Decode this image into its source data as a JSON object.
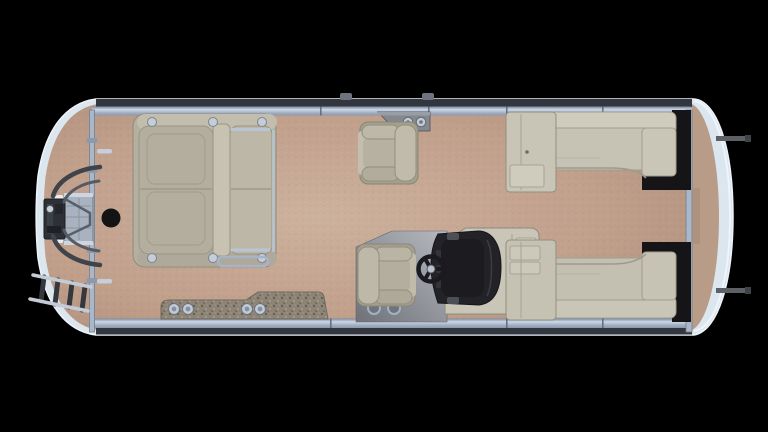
{
  "scene": {
    "type": "pontoon-boat-floorplan-top-view",
    "background": "#000000"
  },
  "palette": {
    "hull_rim": "#dce6ef",
    "hull_edge": "#f2f6fb",
    "rear_deck": "#b99c88",
    "frame_dark": "#32363e",
    "fence_silver": "#aab7c9",
    "bolt_silver": "#c6cdd7",
    "furniture_base": "#b4af9e",
    "furniture_light": "#c7c2b1",
    "furniture_mid": "#b3ae9d",
    "furniture_dark": "#a49f8e",
    "rear_lounge": "#c6c3b4",
    "rear_lounge_light": "#cfccbd",
    "cabinet": "#c8c5b6",
    "accent_black": "#151518",
    "console_body": "#c9c6b8",
    "windshield": "#232327",
    "windshield_inner": "#1b1b20",
    "wheel": "#1a1a1f",
    "hub_silver": "#b9c2cc",
    "mat_edge": "#6f695d",
    "cup_silver": "#c2cad4",
    "motor": "#2d3036",
    "tube": "#3f434a",
    "ladder_silver": "#c3cbd6",
    "rung": "#34373d",
    "pedestal": "#141414",
    "caddy_gray": "#84888f",
    "cleat": "#5d6167"
  },
  "parts": {
    "hull": "pontoon hull top view",
    "deck": "tan carpeted deck",
    "bow_lounge": "bow facing lounge group",
    "table_pedestal": "table pedestal base",
    "companion_chair": "companion chair",
    "captain_chair": "helm captain chair",
    "helm_console": "helm console with dark windscreen",
    "steering_wheel": "steering wheel",
    "rail_caddy": "rail cupholder caddy",
    "port_rear_lounge": "port rear chaise lounge",
    "starboard_rear_lounge": "starboard rear chaise lounge",
    "entry_mats": "textured entry mats with cupholders",
    "boarding_ladder": "bow boarding ladder",
    "bow_platform": "bow gate boarding platform",
    "trolling_motor": "trolling motor",
    "stern_deck": "stern deck",
    "cleats": "stern cleats"
  }
}
